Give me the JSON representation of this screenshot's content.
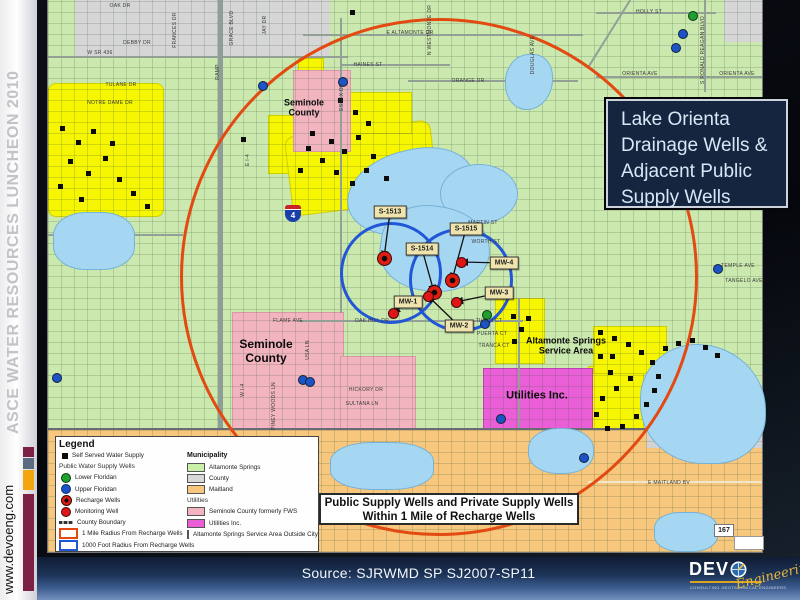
{
  "sidebar": {
    "event": "ASCE WATER RESOURCES LUNCHEON 2010",
    "website": "www.devoeng.com",
    "bar_colors": [
      "#7d2044",
      "#5d6b80",
      "#f3a50d",
      "#7d2044"
    ]
  },
  "title_box": {
    "lines": [
      "Lake Orienta",
      "Drainage Wells &",
      "Adjacent Public",
      "Supply Wells"
    ]
  },
  "info_box": {
    "line1": "Public Supply Wells and Private Supply Wells",
    "line2": "Within 1 Mile of Recharge Wells"
  },
  "source_bar": {
    "text": "Source: SJRWMD SP SJ2007-SP11"
  },
  "logo": {
    "name_prefix": "DEV",
    "script": "Engineering",
    "tagline": "CONSULTING GEOTECHNICAL ENGINEERS"
  },
  "legend": {
    "title": "Legend",
    "wells_section": [
      {
        "symbol": "black-square",
        "label": "Self Served Water Supply"
      },
      {
        "symbol": "none",
        "label": "Public Water Supply Wells",
        "header": true
      },
      {
        "symbol": "green-circle",
        "label": "Lower Floridan"
      },
      {
        "symbol": "blue-circle",
        "label": "Upper Floridan"
      },
      {
        "symbol": "recharge",
        "label": "Recharge Wells"
      },
      {
        "symbol": "red-circle",
        "label": "Monitoring Well"
      },
      {
        "symbol": "boundary-line",
        "label": "County Boundary"
      },
      {
        "symbol": "red-outline",
        "label": "1 Mile Radius From Recharge Wells"
      },
      {
        "symbol": "blue-outline",
        "label": "1000 Foot Radius From Recharge Wells"
      }
    ],
    "municipality_title": "Municipality",
    "municipality": [
      {
        "color": "#c9f0a8",
        "label": "Altamonte Springs"
      },
      {
        "color": "#d8d8d8",
        "label": "County"
      },
      {
        "color": "#f6c77c",
        "label": "Maitland"
      }
    ],
    "utilities_title": "Utilities",
    "utilities": [
      {
        "color": "#f2b5c0",
        "label": "Seminole County formerly FWS"
      },
      {
        "color": "#ea5fd8",
        "label": "Utilities Inc."
      },
      {
        "color": "#f6f600",
        "label": "Altamonte Springs Service Area Outside City"
      }
    ]
  },
  "map": {
    "interstate_label": "4",
    "state_road_label": "167",
    "area_labels": [
      {
        "lines": [
          "Seminole",
          "County"
        ],
        "x": 304,
        "y": 108,
        "size": 9
      },
      {
        "lines": [
          "Seminole",
          "County"
        ],
        "x": 266,
        "y": 352,
        "size": 12
      },
      {
        "lines": [
          "Altamonte Springs",
          "Service Area"
        ],
        "x": 566,
        "y": 346,
        "size": 9
      },
      {
        "lines": [
          "Utilities Inc."
        ],
        "x": 537,
        "y": 396,
        "size": 11
      }
    ],
    "street_labels": [
      {
        "t": "E ALTAMONTE DR",
        "x": 410,
        "y": 33
      },
      {
        "t": "W SR 436",
        "x": 100,
        "y": 53
      },
      {
        "t": "HAINES ST",
        "x": 368,
        "y": 65
      },
      {
        "t": "ORANGE DR",
        "x": 468,
        "y": 81
      },
      {
        "t": "HOLLY ST",
        "x": 649,
        "y": 12
      },
      {
        "t": "ORIENTA AVE",
        "x": 640,
        "y": 74
      },
      {
        "t": "ORIENTA AVE",
        "x": 737,
        "y": 74
      },
      {
        "t": "MARTIN ST",
        "x": 483,
        "y": 223
      },
      {
        "t": "WORTH ST",
        "x": 486,
        "y": 242
      },
      {
        "t": "OAK HILL DR",
        "x": 372,
        "y": 321
      },
      {
        "t": "FLAME AVE",
        "x": 288,
        "y": 321
      },
      {
        "t": "TULANE DR",
        "x": 121,
        "y": 85
      },
      {
        "t": "NOTRE DAME DR",
        "x": 110,
        "y": 103
      },
      {
        "t": "E MAITLAND BV",
        "x": 669,
        "y": 483
      },
      {
        "t": "HICKORY DR",
        "x": 366,
        "y": 390
      },
      {
        "t": "SULTANA LN",
        "x": 362,
        "y": 404
      },
      {
        "t": "TIVOLI CT",
        "x": 489,
        "y": 321
      },
      {
        "t": "PUERTA CT",
        "x": 492,
        "y": 334
      },
      {
        "t": "TRANCA CT",
        "x": 494,
        "y": 346
      },
      {
        "t": "TEMPLE AVE",
        "x": 738,
        "y": 266
      },
      {
        "t": "TANGELO AVE",
        "x": 744,
        "y": 281
      },
      {
        "t": "OAK DR",
        "x": 120,
        "y": 6
      },
      {
        "t": "DEBBY DR",
        "x": 137,
        "y": 43
      },
      {
        "t": "DOUGLAS AVE",
        "x": 533,
        "y": 55,
        "v": true
      },
      {
        "t": "RAMP",
        "x": 218,
        "y": 72,
        "v": true
      },
      {
        "t": "E I-4",
        "x": 248,
        "y": 160,
        "v": true
      },
      {
        "t": "W I-4",
        "x": 243,
        "y": 390,
        "v": true
      },
      {
        "t": "ESSEX DR",
        "x": 342,
        "y": 97,
        "v": true
      },
      {
        "t": "S RONALD REAGAN BLVD",
        "x": 703,
        "y": 50,
        "v": true
      },
      {
        "t": "PINEY WOODS LN",
        "x": 274,
        "y": 406,
        "v": true
      },
      {
        "t": "USA LN",
        "x": 308,
        "y": 350,
        "v": true
      },
      {
        "t": "GRACE BLVD",
        "x": 232,
        "y": 28,
        "v": true
      },
      {
        "t": "FRANCES DR",
        "x": 175,
        "y": 30,
        "v": true
      },
      {
        "t": "JAY DR",
        "x": 265,
        "y": 25,
        "v": true
      },
      {
        "t": "N WESTMONTE DR",
        "x": 430,
        "y": 30,
        "v": true
      }
    ],
    "wells": [
      {
        "label": "S-1513",
        "type": "recharge",
        "box": [
          390,
          212
        ],
        "marker": [
          384,
          258
        ]
      },
      {
        "label": "S-1514",
        "type": "recharge",
        "box": [
          422,
          249
        ],
        "marker": [
          434,
          292
        ]
      },
      {
        "label": "S-1515",
        "type": "recharge",
        "box": [
          466,
          229
        ],
        "marker": [
          452,
          280
        ]
      },
      {
        "label": "MW-1",
        "type": "monitoring",
        "box": [
          408,
          302
        ],
        "marker": [
          393,
          313
        ]
      },
      {
        "label": "MW-2",
        "type": "monitoring",
        "box": [
          459,
          326
        ],
        "marker": [
          428,
          296
        ]
      },
      {
        "label": "MW-3",
        "type": "monitoring",
        "box": [
          499,
          293
        ],
        "marker": [
          456,
          302
        ]
      },
      {
        "label": "MW-4",
        "type": "monitoring",
        "box": [
          504,
          263
        ],
        "marker": [
          461,
          262
        ]
      }
    ],
    "black_squares": [
      [
        62,
        128
      ],
      [
        78,
        142
      ],
      [
        93,
        131
      ],
      [
        70,
        161
      ],
      [
        88,
        173
      ],
      [
        105,
        158
      ],
      [
        119,
        179
      ],
      [
        133,
        193
      ],
      [
        147,
        206
      ],
      [
        81,
        199
      ],
      [
        60,
        186
      ],
      [
        112,
        143
      ],
      [
        308,
        148
      ],
      [
        322,
        160
      ],
      [
        336,
        172
      ],
      [
        352,
        183
      ],
      [
        366,
        170
      ],
      [
        344,
        151
      ],
      [
        312,
        133
      ],
      [
        300,
        170
      ],
      [
        331,
        141
      ],
      [
        358,
        137
      ],
      [
        373,
        156
      ],
      [
        386,
        178
      ],
      [
        340,
        100
      ],
      [
        355,
        112
      ],
      [
        368,
        123
      ],
      [
        352,
        12
      ],
      [
        243,
        139
      ],
      [
        513,
        316
      ],
      [
        521,
        329
      ],
      [
        514,
        341
      ],
      [
        528,
        318
      ],
      [
        600,
        332
      ],
      [
        614,
        338
      ],
      [
        628,
        344
      ],
      [
        641,
        352
      ],
      [
        652,
        362
      ],
      [
        658,
        376
      ],
      [
        654,
        390
      ],
      [
        646,
        404
      ],
      [
        636,
        416
      ],
      [
        622,
        426
      ],
      [
        607,
        428
      ],
      [
        596,
        414
      ],
      [
        602,
        398
      ],
      [
        616,
        388
      ],
      [
        630,
        378
      ],
      [
        610,
        372
      ],
      [
        665,
        348
      ],
      [
        678,
        343
      ],
      [
        692,
        340
      ],
      [
        705,
        347
      ],
      [
        717,
        355
      ],
      [
        600,
        356
      ],
      [
        612,
        356
      ]
    ],
    "dots": [
      {
        "x": 262,
        "y": 85,
        "c": "blue"
      },
      {
        "x": 342,
        "y": 81,
        "c": "blue"
      },
      {
        "x": 682,
        "y": 33,
        "c": "blue"
      },
      {
        "x": 675,
        "y": 47,
        "c": "blue"
      },
      {
        "x": 717,
        "y": 268,
        "c": "blue"
      },
      {
        "x": 302,
        "y": 379,
        "c": "blue"
      },
      {
        "x": 309,
        "y": 381,
        "c": "blue"
      },
      {
        "x": 500,
        "y": 418,
        "c": "blue"
      },
      {
        "x": 583,
        "y": 457,
        "c": "blue"
      },
      {
        "x": 56,
        "y": 377,
        "c": "blue"
      },
      {
        "x": 484,
        "y": 323,
        "c": "blue"
      },
      {
        "x": 692,
        "y": 15,
        "c": "green"
      },
      {
        "x": 486,
        "y": 314,
        "c": "green"
      }
    ]
  },
  "colors": {
    "mile_radius": "#e24a12",
    "ft_radius": "#2156d6",
    "altamonte_springs": "#cbe8ae",
    "county_gray": "#d6d6d6",
    "maitland_orange": "#f6c77c",
    "seminole_fws_pink": "#f2b5c0",
    "utilities_magenta": "#ea5fd8",
    "service_area_yellow": "#f6f600",
    "lake_blue": "#a6d7f2",
    "title_box_bg": "#152540",
    "bottom_bar_blue": "#3c5c8f",
    "logo_gold": "#d9a520"
  }
}
